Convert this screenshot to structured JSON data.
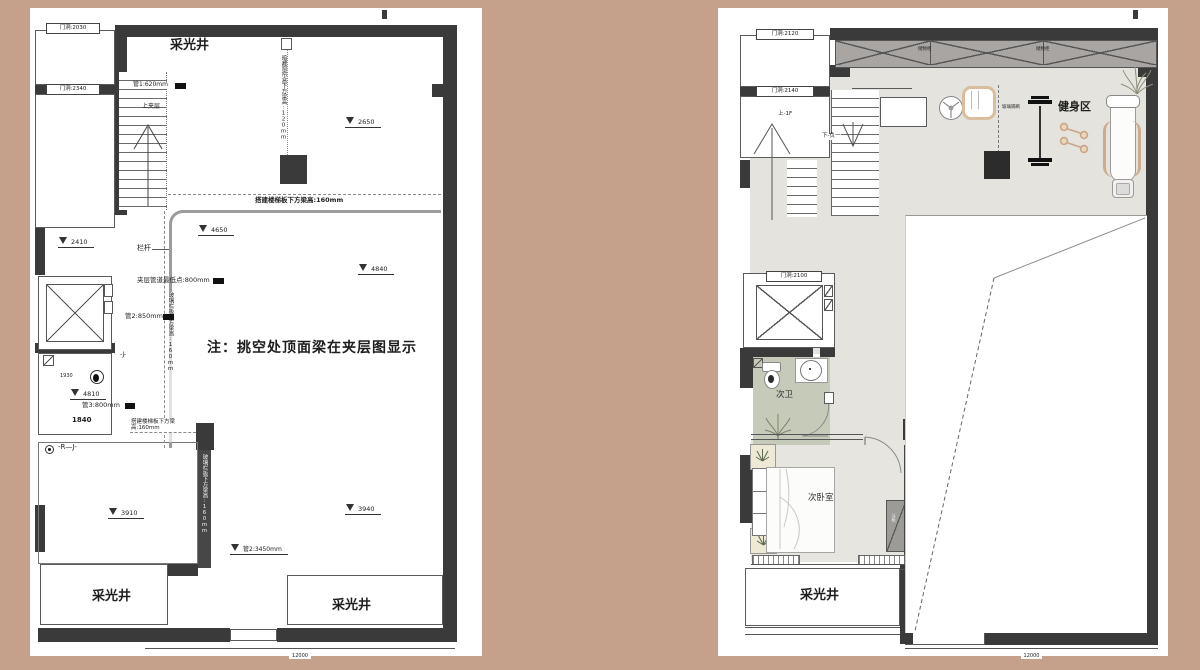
{
  "canvas": {
    "background": "#c5a18c",
    "paper": "#ffffff",
    "wall": "#3a3a3a",
    "bath_floor": "#c6cbb9",
    "gym_floor": "#e4e3dd"
  },
  "left_plan": {
    "note": "注：挑空处顶面梁在夹层图显示",
    "light_well_top": "采光井",
    "light_well_bottom_left": "采光井",
    "light_well_bottom_right": "采光井",
    "door1": "门洞:2030",
    "door2": "门洞:2340",
    "stair_up": "上夹层",
    "pipe1": "管1:620mm",
    "pipe2": "管2:850mm",
    "pipe3": "管3:800mm",
    "pipe4": "管2:3450mm",
    "railing": "栏杆",
    "mezz_pipe": "夹层管道最低点:800mm",
    "beam_stair": "搭建楼梯板下方梁高:160mm",
    "beam_stair2": "搭建楼梯板下方梁高:160mm",
    "curtain_beam": "暗藏窗帘盒下方梁高:120mm",
    "glass_beam1": "玻璃栏板下方梁高:160mm",
    "glass_beam2": "玻璃栏板下方梁高:160mm",
    "elev": {
      "a": "2650",
      "b": "2410",
      "c": "4650",
      "d": "4840",
      "e": "4810",
      "f": "3910",
      "g": "3940"
    },
    "dim1840": "1840",
    "dim1930": "1930",
    "sym_rj": "-R—J-",
    "sym_j": "-J-",
    "dim_bottom": "12000"
  },
  "right_plan": {
    "gym": "健身区",
    "bath": "次卫",
    "bedroom": "次卧室",
    "light_well": "采光井",
    "door2120": "门洞:2120",
    "door2140": "门洞:2140",
    "door2100": "门洞:2100",
    "stair_up": "上-1F",
    "stair_down": "下-负一",
    "cabinet1": "储物柜",
    "cabinet2": "储物柜",
    "glass_partition": "玻璃隔断",
    "dresser": "斗柜",
    "art_wall": "艺术漆墙",
    "dim_bottom": "12000"
  }
}
